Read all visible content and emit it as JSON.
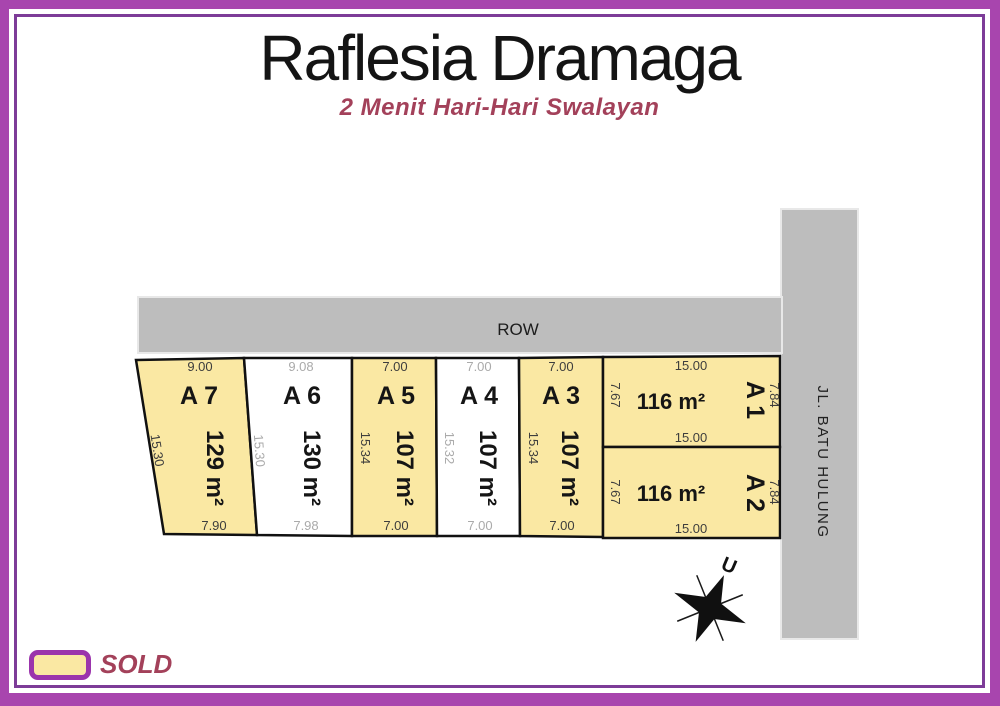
{
  "header": {
    "title": "Raflesia Dramaga",
    "subtitle": "2 Menit Hari-Hari Swalayan"
  },
  "roads": {
    "row_label": "ROW",
    "street_label": "JL. BATU HULUNG"
  },
  "compass": {
    "north_label": "U"
  },
  "legend": {
    "sold_label": "SOLD"
  },
  "colors": {
    "sold_fill": "#FAE8A3",
    "available_fill": "#FFFFFF",
    "road_fill": "#BDBDBD",
    "frame_outer": "#A845AE",
    "frame_inner": "#7D3C98",
    "accent_text": "#A3415A"
  },
  "plots": [
    {
      "id": "A 7",
      "area": "129 m²",
      "status": "sold",
      "dims": {
        "top": "9.00",
        "left": "15.30",
        "bottom": "7.90"
      }
    },
    {
      "id": "A 6",
      "area": "130 m²",
      "status": "available",
      "dims": {
        "top": "9.08",
        "left": "15.30",
        "bottom": "7.98"
      }
    },
    {
      "id": "A 5",
      "area": "107 m²",
      "status": "sold",
      "dims": {
        "top": "7.00",
        "left": "15.34",
        "bottom": "7.00"
      }
    },
    {
      "id": "A 4",
      "area": "107 m²",
      "status": "available",
      "dims": {
        "top": "7.00",
        "left": "15.32",
        "bottom": "7.00"
      }
    },
    {
      "id": "A 3",
      "area": "107 m²",
      "status": "sold",
      "dims": {
        "top": "7.00",
        "left": "15.34",
        "bottom": "7.00"
      }
    },
    {
      "id": "A 1",
      "area": "116 m²",
      "status": "sold",
      "dims": {
        "top": "15.00",
        "left": "7.67",
        "right": "7.84",
        "bottom": "15.00"
      }
    },
    {
      "id": "A 2",
      "area": "116 m²",
      "status": "sold",
      "dims": {
        "left": "7.67",
        "right": "7.84",
        "bottom": "15.00"
      }
    }
  ]
}
